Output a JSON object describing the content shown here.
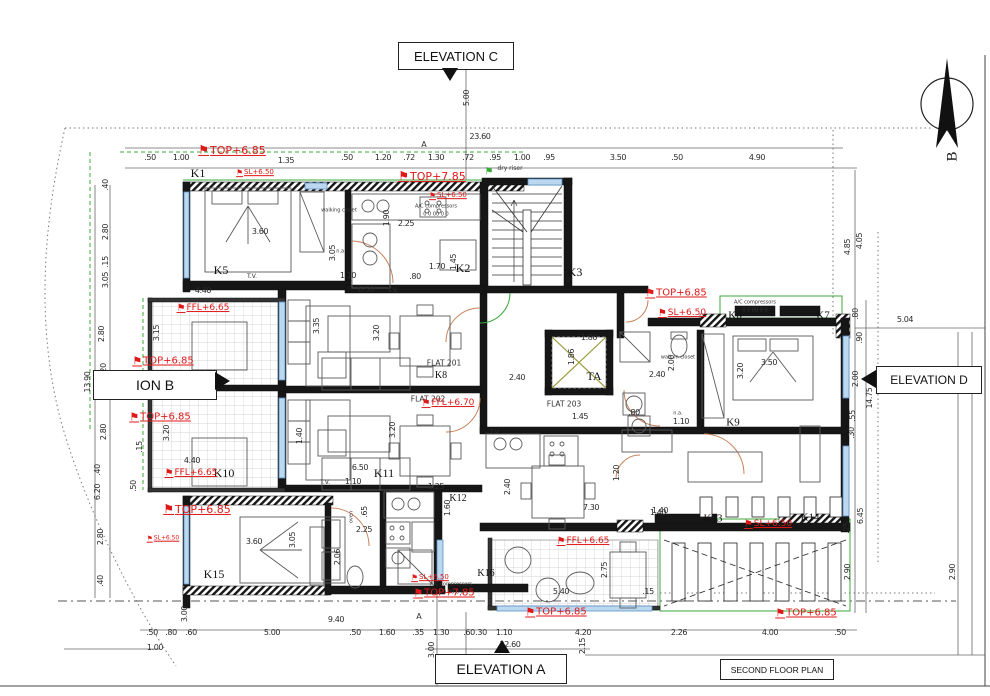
{
  "icons": {
    "flag": "⚑",
    "north_letter": "B"
  },
  "boxed": {
    "elevation_c": "ELEVATION C",
    "elevation_b": "ION B",
    "elevation_d": "ELEVATION D",
    "elevation_a": "ELEVATION A",
    "floor_plan": "SECOND FLOOR PLAN"
  },
  "levels": [
    {
      "t": "TOP+6.85",
      "x": 232,
      "y": 150,
      "s": 11
    },
    {
      "t": "SL+6.50",
      "x": 255,
      "y": 173,
      "s": 7
    },
    {
      "t": "TOP+7.85",
      "x": 432,
      "y": 176,
      "s": 11
    },
    {
      "t": "SL+6.50",
      "x": 448,
      "y": 196,
      "s": 7
    },
    {
      "t": "TOP+6.85",
      "x": 676,
      "y": 293,
      "s": 10
    },
    {
      "t": "SL+6.50",
      "x": 682,
      "y": 314,
      "s": 9
    },
    {
      "t": "FFL+6.65",
      "x": 203,
      "y": 309,
      "s": 9
    },
    {
      "t": "TOP+6.85",
      "x": 163,
      "y": 361,
      "s": 10
    },
    {
      "t": "TOP+6.85",
      "x": 160,
      "y": 417,
      "s": 10
    },
    {
      "t": "FFL+6.65",
      "x": 191,
      "y": 474,
      "s": 9
    },
    {
      "t": "FFL+6.70",
      "x": 448,
      "y": 404,
      "s": 9
    },
    {
      "t": "TOP+6.85",
      "x": 197,
      "y": 509,
      "s": 11
    },
    {
      "t": "SL+6.50",
      "x": 163,
      "y": 539,
      "s": 6
    },
    {
      "t": "SL+6.50",
      "x": 430,
      "y": 578,
      "s": 7
    },
    {
      "t": "TOP+7.85",
      "x": 444,
      "y": 593,
      "s": 10
    },
    {
      "t": "FFL+6.65",
      "x": 583,
      "y": 542,
      "s": 9
    },
    {
      "t": "SL+6.50",
      "x": 768,
      "y": 525,
      "s": 9
    },
    {
      "t": "TOP+6.85",
      "x": 556,
      "y": 612,
      "s": 10
    },
    {
      "t": "TOP+6.85",
      "x": 806,
      "y": 613,
      "s": 10
    }
  ],
  "rooms": [
    {
      "t": "K1",
      "x": 198,
      "y": 173,
      "s": 12
    },
    {
      "t": "K2",
      "x": 463,
      "y": 268,
      "s": 12
    },
    {
      "t": "K3",
      "x": 575,
      "y": 272,
      "s": 12
    },
    {
      "t": "K5",
      "x": 221,
      "y": 270,
      "s": 12
    },
    {
      "t": "K6",
      "x": 735,
      "y": 316,
      "s": 11
    },
    {
      "t": "K7",
      "x": 823,
      "y": 316,
      "s": 11
    },
    {
      "t": "K8",
      "x": 441,
      "y": 376,
      "s": 10
    },
    {
      "t": "K9",
      "x": 733,
      "y": 423,
      "s": 11
    },
    {
      "t": "K10",
      "x": 224,
      "y": 473,
      "s": 12
    },
    {
      "t": "K11",
      "x": 384,
      "y": 473,
      "s": 12
    },
    {
      "t": "K12",
      "x": 458,
      "y": 499,
      "s": 10
    },
    {
      "t": "K13",
      "x": 713,
      "y": 519,
      "s": 11
    },
    {
      "t": "K14",
      "x": 810,
      "y": 518,
      "s": 11
    },
    {
      "t": "K15",
      "x": 214,
      "y": 574,
      "s": 12
    },
    {
      "t": "K16",
      "x": 486,
      "y": 574,
      "s": 10
    },
    {
      "t": "TA",
      "x": 594,
      "y": 376,
      "s": 12
    }
  ],
  "flats": [
    {
      "t": "FLAT 201",
      "x": 444,
      "y": 363
    },
    {
      "t": "FLAT 202",
      "x": 428,
      "y": 399
    },
    {
      "t": "FLAT 203",
      "x": 564,
      "y": 404
    }
  ],
  "dims": [
    {
      "t": ".50",
      "x": 150,
      "y": 158
    },
    {
      "t": "1.00",
      "x": 181,
      "y": 158
    },
    {
      "t": "1.35",
      "x": 286,
      "y": 161
    },
    {
      "t": ".50",
      "x": 347,
      "y": 158
    },
    {
      "t": "1.20",
      "x": 383,
      "y": 158
    },
    {
      "t": ".72",
      "x": 409,
      "y": 158
    },
    {
      "t": "1.30",
      "x": 436,
      "y": 158
    },
    {
      "t": ".72",
      "x": 468,
      "y": 158
    },
    {
      "t": ".95",
      "x": 495,
      "y": 158
    },
    {
      "t": "1.00",
      "x": 522,
      "y": 158
    },
    {
      "t": ".95",
      "x": 549,
      "y": 158
    },
    {
      "t": "3.50",
      "x": 618,
      "y": 158
    },
    {
      "t": ".50",
      "x": 677,
      "y": 158
    },
    {
      "t": "4.90",
      "x": 757,
      "y": 158
    },
    {
      "t": "23.60",
      "x": 480,
      "y": 137
    },
    {
      "t": "5.00",
      "x": 467,
      "y": 98,
      "r": 1
    },
    {
      "t": ".50",
      "x": 152,
      "y": 633
    },
    {
      "t": ".80",
      "x": 171,
      "y": 633
    },
    {
      "t": ".60",
      "x": 191,
      "y": 633
    },
    {
      "t": "5.00",
      "x": 272,
      "y": 633
    },
    {
      "t": ".50",
      "x": 355,
      "y": 633
    },
    {
      "t": "1.60",
      "x": 387,
      "y": 633
    },
    {
      "t": ".35",
      "x": 418,
      "y": 633
    },
    {
      "t": "1.30",
      "x": 441,
      "y": 633
    },
    {
      "t": ".60",
      "x": 469,
      "y": 633
    },
    {
      "t": ".30",
      "x": 481,
      "y": 633
    },
    {
      "t": "1.10",
      "x": 504,
      "y": 633
    },
    {
      "t": "4.20",
      "x": 583,
      "y": 633
    },
    {
      "t": "2.26",
      "x": 679,
      "y": 633
    },
    {
      "t": "4.00",
      "x": 770,
      "y": 633
    },
    {
      "t": ".50",
      "x": 840,
      "y": 633
    },
    {
      "t": "9.40",
      "x": 336,
      "y": 620
    },
    {
      "t": "22.60",
      "x": 510,
      "y": 645
    },
    {
      "t": "1.00",
      "x": 155,
      "y": 648
    },
    {
      "t": "3.00",
      "x": 432,
      "y": 650,
      "r": 1
    },
    {
      "t": "2.15",
      "x": 583,
      "y": 646,
      "r": 1
    },
    {
      "t": "3.00",
      "x": 185,
      "y": 614,
      "r": 1
    },
    {
      "t": ".40",
      "x": 106,
      "y": 185,
      "r": 1
    },
    {
      "t": "2.80",
      "x": 106,
      "y": 232,
      "r": 1
    },
    {
      "t": ".15",
      "x": 106,
      "y": 262,
      "r": 1
    },
    {
      "t": "3.05",
      "x": 106,
      "y": 280,
      "r": 1
    },
    {
      "t": "2.80",
      "x": 102,
      "y": 334,
      "r": 1
    },
    {
      "t": ".20",
      "x": 104,
      "y": 369,
      "r": 1
    },
    {
      "t": ".50",
      "x": 104,
      "y": 382,
      "r": 1
    },
    {
      "t": ".20",
      "x": 104,
      "y": 395,
      "r": 1
    },
    {
      "t": "13.90",
      "x": 88,
      "y": 382,
      "r": 1
    },
    {
      "t": "7.16",
      "x": 117,
      "y": 381,
      "r": 1
    },
    {
      "t": "2.80",
      "x": 104,
      "y": 432,
      "r": 1
    },
    {
      "t": ".15",
      "x": 140,
      "y": 447,
      "r": 1
    },
    {
      "t": ".40",
      "x": 98,
      "y": 470,
      "r": 1
    },
    {
      "t": "6.20",
      "x": 98,
      "y": 492,
      "r": 1
    },
    {
      "t": ".50",
      "x": 134,
      "y": 486,
      "r": 1
    },
    {
      "t": "2.80",
      "x": 101,
      "y": 537,
      "r": 1
    },
    {
      "t": ".40",
      "x": 101,
      "y": 581,
      "r": 1
    },
    {
      "t": "4.85",
      "x": 848,
      "y": 247,
      "r": 1
    },
    {
      "t": "4.05",
      "x": 860,
      "y": 241,
      "r": 1
    },
    {
      "t": ".80",
      "x": 856,
      "y": 314,
      "r": 1
    },
    {
      "t": ".90",
      "x": 860,
      "y": 338,
      "r": 1
    },
    {
      "t": "2.00",
      "x": 856,
      "y": 379,
      "r": 1
    },
    {
      "t": "14.75",
      "x": 870,
      "y": 398,
      "r": 1
    },
    {
      "t": ".55",
      "x": 853,
      "y": 416,
      "r": 1
    },
    {
      "t": ".30",
      "x": 852,
      "y": 433,
      "r": 1
    },
    {
      "t": "5.04",
      "x": 905,
      "y": 320
    },
    {
      "t": "1.40",
      "x": 660,
      "y": 511
    },
    {
      "t": ".25",
      "x": 847,
      "y": 528,
      "r": 1
    },
    {
      "t": "2.90",
      "x": 848,
      "y": 572,
      "r": 1
    },
    {
      "t": "6.45",
      "x": 861,
      "y": 516,
      "r": 1
    },
    {
      "t": "2.90",
      "x": 953,
      "y": 572,
      "r": 1
    },
    {
      "t": "3.60",
      "x": 260,
      "y": 232
    },
    {
      "t": "3.05",
      "x": 333,
      "y": 253,
      "r": 1
    },
    {
      "t": "1.90",
      "x": 387,
      "y": 218,
      "r": 1
    },
    {
      "t": "2.25",
      "x": 406,
      "y": 224
    },
    {
      "t": "1.70",
      "x": 437,
      "y": 267
    },
    {
      "t": "1.45",
      "x": 454,
      "y": 262,
      "r": 1
    },
    {
      "t": ".80",
      "x": 415,
      "y": 277
    },
    {
      "t": "1.10",
      "x": 348,
      "y": 276
    },
    {
      "t": "4.40",
      "x": 203,
      "y": 291
    },
    {
      "t": "6.50",
      "x": 366,
      "y": 290
    },
    {
      "t": "3.15",
      "x": 157,
      "y": 333,
      "r": 1
    },
    {
      "t": "3.35",
      "x": 317,
      "y": 326,
      "r": 1
    },
    {
      "t": "3.20",
      "x": 377,
      "y": 333,
      "r": 1
    },
    {
      "t": "2.40",
      "x": 517,
      "y": 378
    },
    {
      "t": "1.80",
      "x": 589,
      "y": 338
    },
    {
      "t": "1.86",
      "x": 572,
      "y": 357,
      "r": 1
    },
    {
      "t": "2.40",
      "x": 657,
      "y": 375
    },
    {
      "t": "2.00",
      "x": 672,
      "y": 363,
      "r": 1
    },
    {
      "t": "3.20",
      "x": 741,
      "y": 371,
      "r": 1
    },
    {
      "t": "3.50",
      "x": 769,
      "y": 363
    },
    {
      "t": "1.10",
      "x": 681,
      "y": 422
    },
    {
      "t": ".80",
      "x": 634,
      "y": 413
    },
    {
      "t": "1.45",
      "x": 580,
      "y": 417
    },
    {
      "t": "3.20",
      "x": 393,
      "y": 430,
      "r": 1
    },
    {
      "t": "1.40",
      "x": 300,
      "y": 436,
      "r": 1
    },
    {
      "t": "6.50",
      "x": 360,
      "y": 468
    },
    {
      "t": "1.10",
      "x": 353,
      "y": 482
    },
    {
      "t": "1.25",
      "x": 436,
      "y": 487
    },
    {
      "t": "1.60",
      "x": 448,
      "y": 508,
      "r": 1
    },
    {
      "t": ".65",
      "x": 365,
      "y": 512,
      "r": 1
    },
    {
      "t": "2.25",
      "x": 364,
      "y": 530
    },
    {
      "t": "2.06",
      "x": 338,
      "y": 557,
      "r": 1
    },
    {
      "t": "3.05",
      "x": 293,
      "y": 540,
      "r": 1
    },
    {
      "t": "3.60",
      "x": 254,
      "y": 542
    },
    {
      "t": "4.40",
      "x": 192,
      "y": 461
    },
    {
      "t": "3.20",
      "x": 167,
      "y": 433,
      "r": 1
    },
    {
      "t": "2.40",
      "x": 508,
      "y": 487,
      "r": 1
    },
    {
      "t": "7.30",
      "x": 591,
      "y": 508
    },
    {
      "t": "1.20",
      "x": 617,
      "y": 473,
      "r": 1
    },
    {
      "t": "1.40",
      "x": 658,
      "y": 513
    },
    {
      "t": "5.40",
      "x": 561,
      "y": 592
    },
    {
      "t": "2.75",
      "x": 605,
      "y": 570,
      "r": 1
    },
    {
      "t": ".15",
      "x": 648,
      "y": 592
    }
  ],
  "notes": [
    {
      "t": "dry riser",
      "x": 510,
      "y": 169,
      "s": 6
    },
    {
      "t": "A/C compressors",
      "x": 436,
      "y": 207,
      "s": 5
    },
    {
      "t": "0 0 00 0 0",
      "x": 436,
      "y": 215,
      "s": 5
    },
    {
      "t": "A/C compressors",
      "x": 755,
      "y": 303,
      "s": 5
    },
    {
      "t": "0 0 00 0 0",
      "x": 755,
      "y": 311,
      "s": 5
    },
    {
      "t": "A/C compressors",
      "x": 451,
      "y": 585,
      "s": 5
    },
    {
      "t": "0 0 00 0 0",
      "x": 451,
      "y": 593,
      "s": 5
    },
    {
      "t": "walking closet",
      "x": 339,
      "y": 211,
      "s": 5
    },
    {
      "t": "walk-in closet",
      "x": 678,
      "y": 358,
      "s": 5
    },
    {
      "t": "T.V.",
      "x": 252,
      "y": 277,
      "s": 6
    },
    {
      "t": "T.V.",
      "x": 325,
      "y": 483,
      "s": 6
    },
    {
      "t": "T.V.",
      "x": 495,
      "y": 433,
      "s": 6
    },
    {
      "t": "T.V.",
      "x": 393,
      "y": 291,
      "s": 6
    },
    {
      "t": "n.a.",
      "x": 341,
      "y": 252,
      "s": 5
    },
    {
      "t": "n.a.",
      "x": 678,
      "y": 414,
      "s": 5
    },
    {
      "t": "oven",
      "x": 352,
      "y": 517,
      "s": 5,
      "r": 1
    }
  ],
  "markers": [
    {
      "t": "A",
      "x": 424,
      "y": 145
    },
    {
      "t": "A",
      "x": 419,
      "y": 617
    }
  ]
}
